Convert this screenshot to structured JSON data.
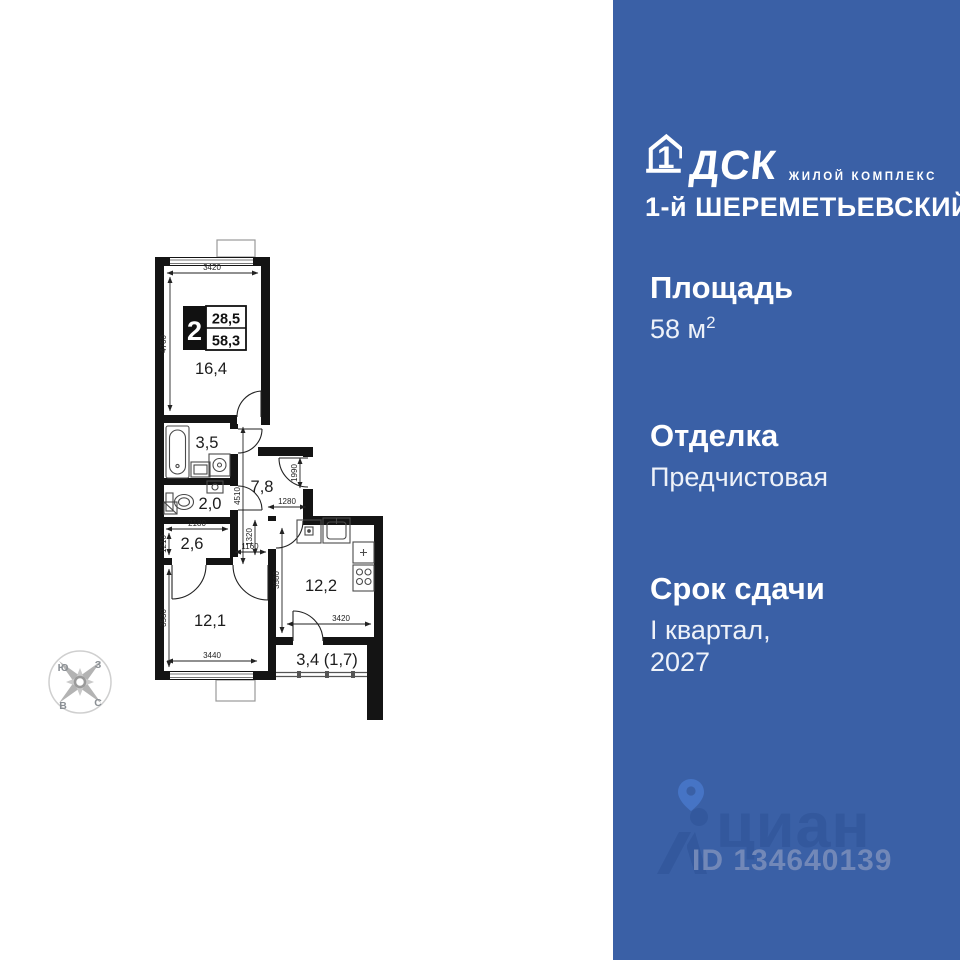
{
  "colors": {
    "panel_blue": "#3a60a6",
    "wall_black": "#141414",
    "watermark_blue": "#33589d",
    "pin_blue": "#4674c5",
    "id_blue": "#7288b8"
  },
  "plan": {
    "info": {
      "rooms": "2",
      "living_area": "28,5",
      "total_area": "58,3"
    },
    "rooms": {
      "living": "16,4",
      "bath": "3,5",
      "wc": "2,0",
      "hall": "7,8",
      "corridor": "2,6",
      "bedroom": "12,1",
      "kitchen": "12,2",
      "balcony": "3,4 (1,7)"
    },
    "dims": {
      "top_3420": "3420",
      "living_4760": "4760",
      "hall_4510": "4510",
      "entry_1990": "1990",
      "hall_1280": "1280",
      "corr_2180": "2180",
      "corr_1210": "1210",
      "pass_1320": "1320",
      "pass_1160": "1160",
      "bed_3530": "3530",
      "bed_3440": "3440",
      "kit_3580": "3580",
      "kit_3420": "3420"
    },
    "compass": {
      "nw": "Ю",
      "ne": "З",
      "sw": "В",
      "se": "С"
    }
  },
  "panel": {
    "logo": {
      "one": "1",
      "dsk": "ДСК",
      "tagline": "ЖИЛОЙ КОМПЛЕКС",
      "name": "1-й ШЕРЕМЕТЬЕВСКИЙ"
    },
    "area": {
      "title": "Площадь",
      "value": "58 м",
      "sup": "2"
    },
    "finish": {
      "title": "Отделка",
      "value": "Предчистовая"
    },
    "deadline": {
      "title": "Срок сдачи",
      "line1": "I квартал,",
      "line2": "2027"
    },
    "watermark": {
      "brand": "циан",
      "listing_id": "ID 134640139"
    }
  }
}
